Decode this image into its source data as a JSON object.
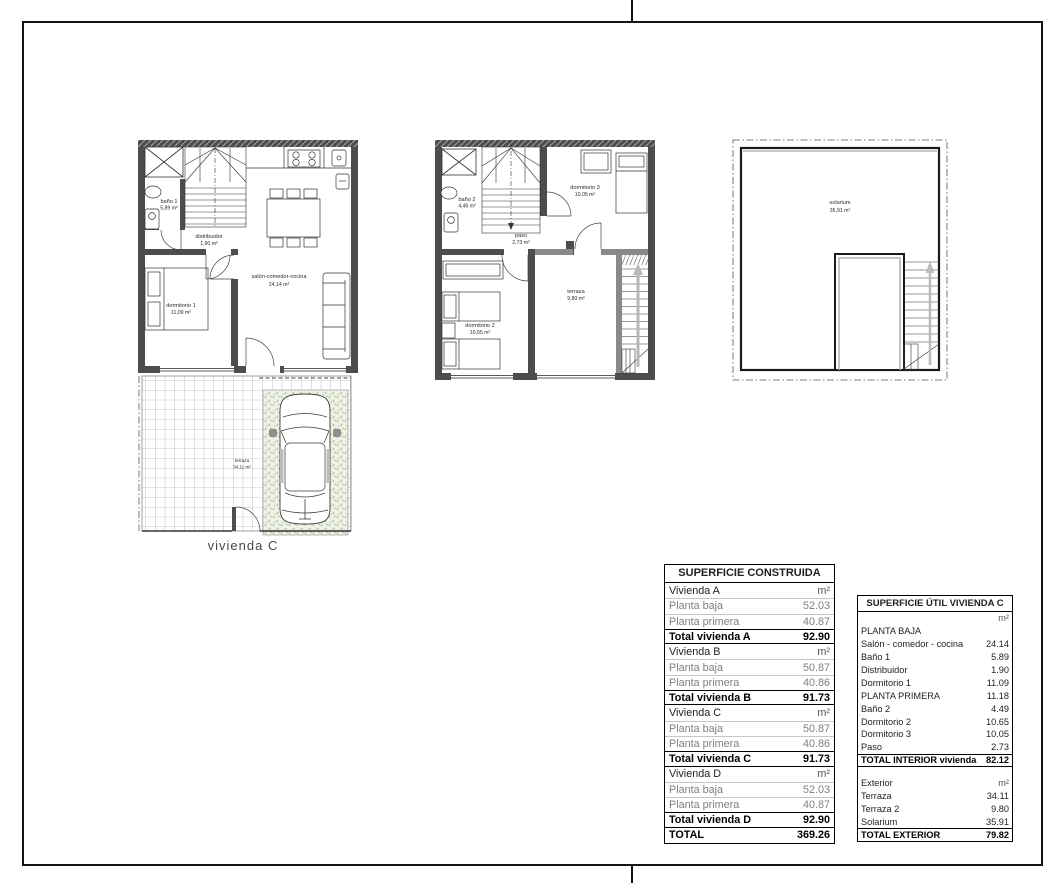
{
  "page": {
    "caption": "vivienda C"
  },
  "plans": {
    "planta_baja": {
      "bano1": {
        "name": "baño 1",
        "area": "5,89 m²"
      },
      "distribuidor": {
        "name": "distribuidor",
        "area": "1,90 m²"
      },
      "dormitorio1": {
        "name": "dormitorio 1",
        "area": "11,09 m²"
      },
      "salon": {
        "name": "salón-comedor-cocina",
        "area": "24,14 m²"
      }
    },
    "planta_primera": {
      "bano2": {
        "name": "baño 2",
        "area": "4,49 m²"
      },
      "dormitorio3": {
        "name": "dormitorio 3",
        "area": "10,05 m²"
      },
      "paso": {
        "name": "paso",
        "area": "2,73 m²"
      },
      "dormitorio2": {
        "name": "dormitorio 2",
        "area": "10,65 m²"
      },
      "terraza": {
        "name": "terraza",
        "area": "9,80 m²"
      }
    },
    "solarium": {
      "solarium": {
        "name": "solarium",
        "area": "35,91 m²"
      }
    },
    "garden": {
      "terraza": {
        "name": "terraza",
        "area": "34,11 m²"
      }
    }
  },
  "tables": {
    "construida": {
      "title": "SUPERFICIE CONSTRUIDA",
      "rows": [
        {
          "label": "Vivienda A",
          "value": "m²"
        },
        {
          "label": "Planta baja",
          "value": "52.03"
        },
        {
          "label": "Planta primera",
          "value": "40.87"
        },
        {
          "label": "Total vivienda A",
          "value": "92.90"
        },
        {
          "label": "Vivienda B",
          "value": "m²"
        },
        {
          "label": "Planta baja",
          "value": "50.87"
        },
        {
          "label": "Planta primera",
          "value": "40.86"
        },
        {
          "label": "Total vivienda B",
          "value": "91.73"
        },
        {
          "label": "Vivienda C",
          "value": "m²"
        },
        {
          "label": "Planta baja",
          "value": "50.87"
        },
        {
          "label": "Planta primera",
          "value": "40.86"
        },
        {
          "label": "Total vivienda C",
          "value": "91.73"
        },
        {
          "label": "Vivienda D",
          "value": "m²"
        },
        {
          "label": "Planta baja",
          "value": "52.03"
        },
        {
          "label": "Planta primera",
          "value": "40.87"
        },
        {
          "label": "Total vivienda D",
          "value": "92.90"
        },
        {
          "label": "TOTAL",
          "value": "369.26"
        }
      ]
    },
    "util": {
      "title": "SUPERFICIE ÚTIL VIVIENDA C",
      "rows": [
        {
          "label": "",
          "value": "m²"
        },
        {
          "label": "PLANTA BAJA",
          "value": ""
        },
        {
          "label": "Salón - comedor - cocina",
          "value": "24.14"
        },
        {
          "label": "Baño 1",
          "value": "5.89"
        },
        {
          "label": "Distribuidor",
          "value": "1.90"
        },
        {
          "label": "Dormitorio 1",
          "value": "11.09"
        },
        {
          "label": "PLANTA PRIMERA",
          "value": "11.18"
        },
        {
          "label": "Baño 2",
          "value": "4.49"
        },
        {
          "label": "Dormitorio 2",
          "value": "10.65"
        },
        {
          "label": "Dormitorio 3",
          "value": "10.05"
        },
        {
          "label": "Paso",
          "value": "2.73"
        },
        {
          "label": "TOTAL INTERIOR vivienda",
          "value": "82.12"
        },
        {
          "label": "Exterior",
          "value": "m²"
        },
        {
          "label": "Terraza",
          "value": "34.11"
        },
        {
          "label": "Terraza 2",
          "value": "9.80"
        },
        {
          "label": "Solarium",
          "value": "35.91"
        },
        {
          "label": "TOTAL EXTERIOR",
          "value": "79.82"
        }
      ]
    }
  }
}
